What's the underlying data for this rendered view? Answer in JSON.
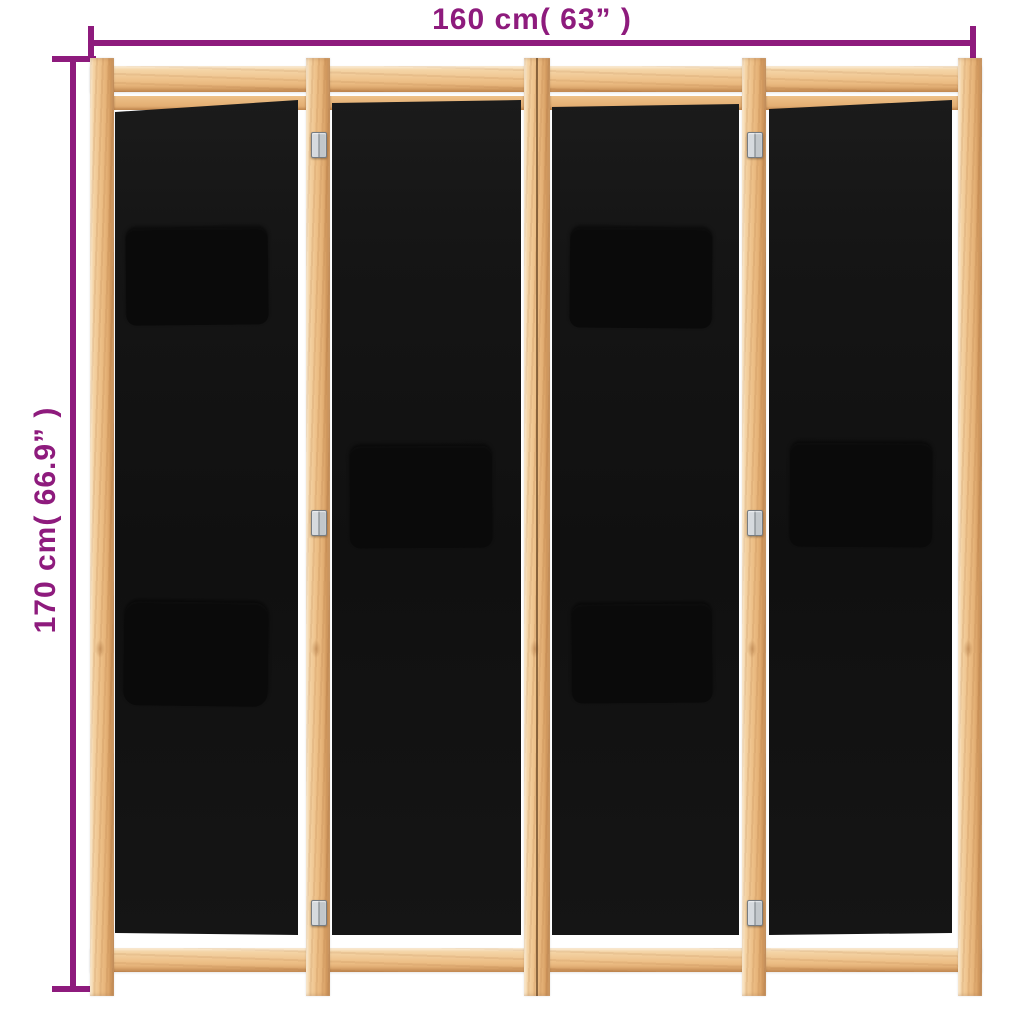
{
  "title": "4-panel room divider with dimension annotations",
  "annotations": {
    "width_label": "160 cm( 63” )",
    "height_label": "170 cm( 66.9” )"
  },
  "colors": {
    "annotation": "#8e1b7d",
    "background": "#ffffff",
    "wood_light": "#f7dcb2",
    "wood_mid": "#eec189",
    "wood_dark": "#dfa76a",
    "wood_grain": "#a66a37",
    "fabric": "#151515",
    "fabric_dark": "#101010",
    "pocket": "#0a0a0a",
    "hinge_light": "#d6dade",
    "hinge_dark": "#84898e"
  },
  "divider": {
    "panel_count": 4,
    "frame_material": "wood",
    "fabric_color": "black",
    "hinge_count": 6,
    "panels": [
      {
        "id": "panel-1",
        "pockets": [
          "upper",
          "lower"
        ]
      },
      {
        "id": "panel-2",
        "pockets": [
          "middle"
        ]
      },
      {
        "id": "panel-3",
        "pockets": [
          "upper",
          "lower"
        ]
      },
      {
        "id": "panel-4",
        "pockets": [
          "middle"
        ]
      }
    ]
  }
}
